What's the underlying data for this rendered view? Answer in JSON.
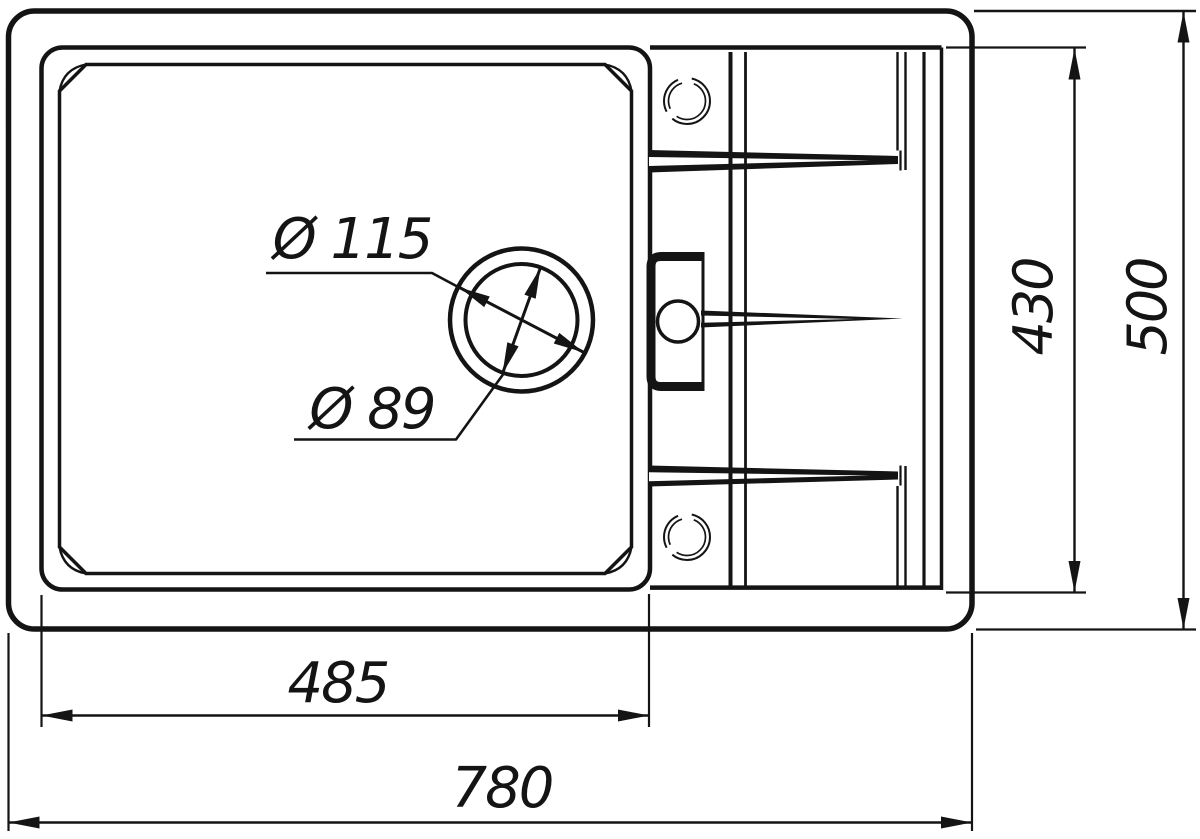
{
  "drawing": {
    "kind": "sink-top-view-dimension-drawing",
    "colors": {
      "line": "#141414",
      "background": "#ffffff"
    },
    "labels": {
      "drain_outer_diameter": "Ø 115",
      "drain_inner_diameter": "Ø 89",
      "bowl_width": "485",
      "overall_width": "780",
      "interior_depth": "430",
      "overall_depth": "500"
    }
  }
}
